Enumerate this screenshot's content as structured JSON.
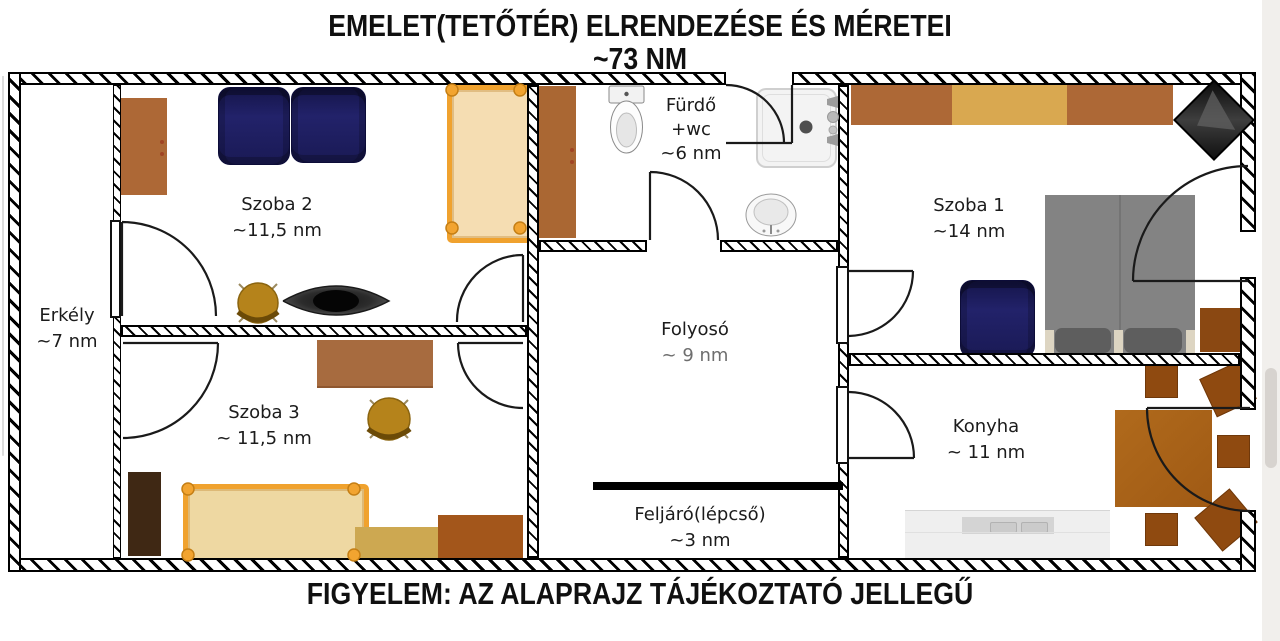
{
  "title": {
    "line1": "EMELET(TETŐTÉR) ELRENDEZÉSE ÉS MÉRETEI",
    "line2": "~73 NM"
  },
  "footer": {
    "note": "FIGYELEM: AZ ALAPRAJZ TÁJÉKOZTATÓ JELLEGŰ"
  },
  "rooms": {
    "erkely": {
      "name": "Erkély",
      "area": "~7 nm"
    },
    "szoba2": {
      "name": "Szoba 2",
      "area": "~11,5 nm"
    },
    "szoba3": {
      "name": "Szoba 3",
      "area": "~ 11,5 nm"
    },
    "furdo": {
      "name": "Fürdő",
      "name2": "+wc",
      "area": "~6 nm"
    },
    "folyoso": {
      "name": "Folyosó",
      "area": "~ 9 nm"
    },
    "feljaro": {
      "name": "Feljáró(lépcső)",
      "area": "~3 nm"
    },
    "szoba1": {
      "name": "Szoba 1",
      "area": "~14 nm"
    },
    "konyha": {
      "name": "Konyha",
      "area": "~ 11 nm"
    }
  },
  "colors": {
    "wall_line": "#000000",
    "wood_brown": "#ad6836",
    "wood_tan": "#d9a850",
    "wood_dark": "#3f2814",
    "navy_chair": "#22226a",
    "bed_frame": "#f0a22e",
    "bed_fill": "#f5ddb2",
    "gold_chair": "#b5831b",
    "bed_gray": "#838383",
    "kitchen_wood": "#a05a14",
    "counter_gray": "#efefef",
    "scrollbar_track": "#f1efec",
    "scrollbar_thumb": "#d7d3cf"
  }
}
